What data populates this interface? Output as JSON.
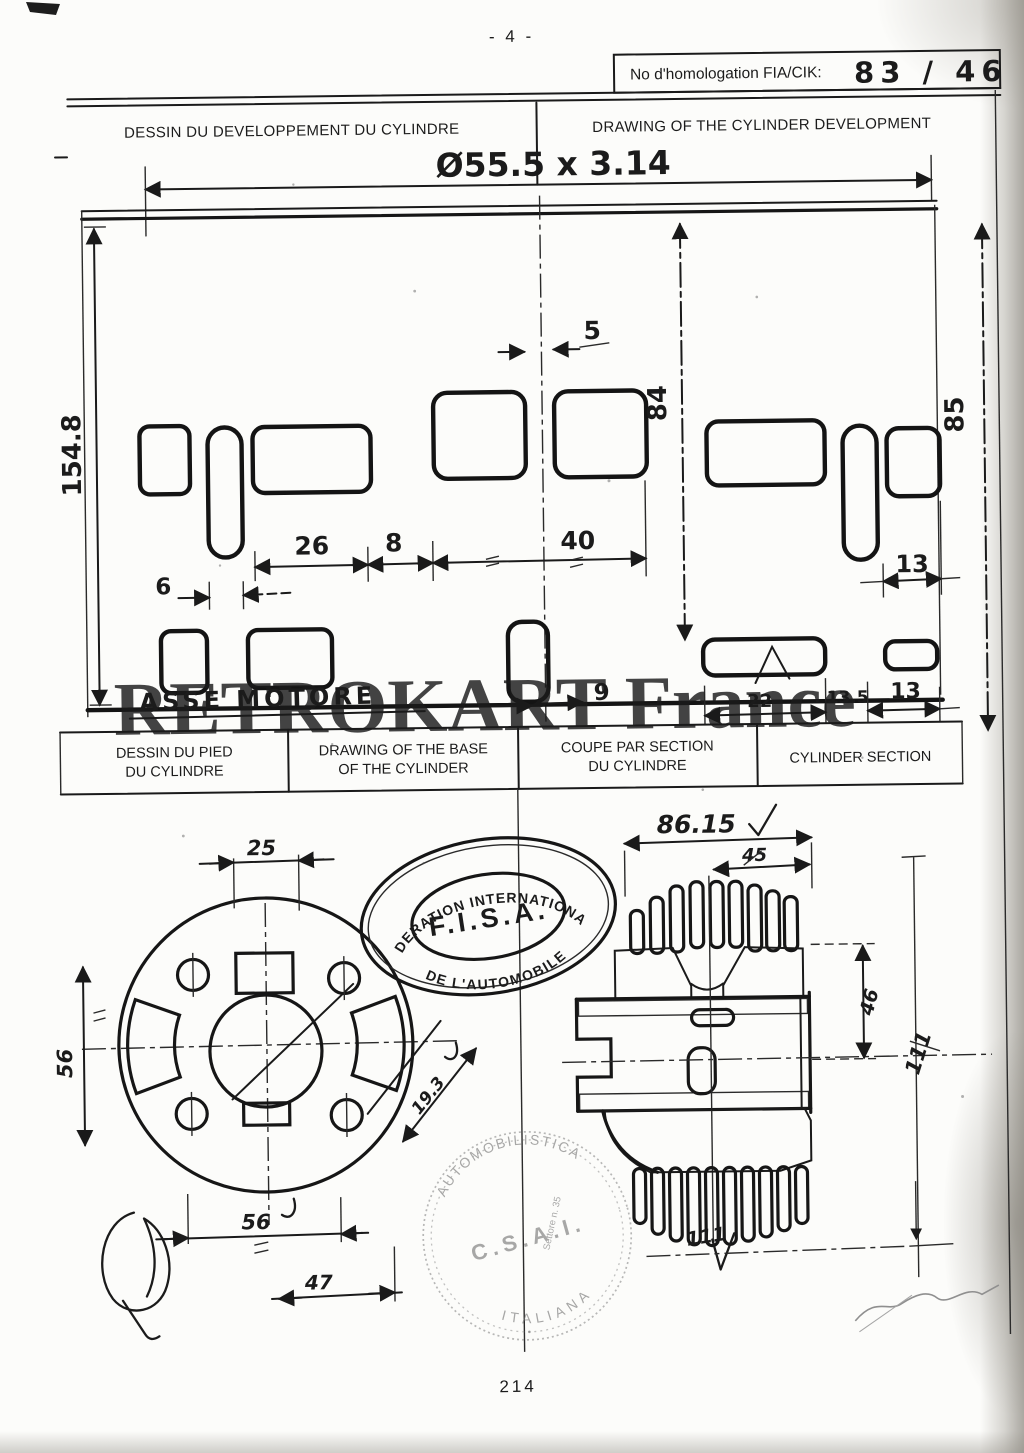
{
  "page": {
    "top_number": "- 4 -",
    "bottom_number": "214"
  },
  "homologation": {
    "label": "No d'homologation FIA/CIK:",
    "number": "83 / 46"
  },
  "titles": {
    "development_fr": "DESSIN DU DEVELOPPEMENT DU CYLINDRE",
    "development_en": "DRAWING OF THE CYLINDER DEVELOPMENT"
  },
  "table_headers": [
    [
      "DESSIN DU PIED",
      "DU CYLINDRE"
    ],
    [
      "DRAWING OF THE BASE",
      "OF THE CYLINDER"
    ],
    [
      "COUPE PAR SECTION",
      "DU CYLINDRE"
    ],
    [
      "CYLINDER SECTION",
      ""
    ]
  ],
  "development": {
    "top_dim": "Ø55.5 x 3.14",
    "height": "154.8",
    "port_height": "84",
    "outer_height": "85",
    "gap": "5",
    "w26": "26",
    "w8": "8",
    "w40": "40",
    "w6": "6",
    "w13_top": "13",
    "w9": "9",
    "w22": "22",
    "w13_5": "13.5",
    "w13_bottom": "13",
    "axis_note": "ASSE MOTORE"
  },
  "base": {
    "top": "25",
    "left": "56",
    "bottom_width": "56",
    "offset": "47",
    "diag": "19.3"
  },
  "section": {
    "overall_width": "86.15",
    "fin_width": "45",
    "inner_height": "46",
    "right_height": "111",
    "bottom_width": "111"
  },
  "stamps": {
    "fisa": {
      "top": "FEDERATION INTERNATIONALE",
      "center": "F.I.S.A.",
      "bottom": "DE L'AUTOMOBILE"
    },
    "csai": {
      "ring_top": "AUTOMOBILISTICA",
      "ring_bottom": "ITALIANA",
      "center": "C.S.A.I.",
      "small": "Settore n. 35"
    }
  },
  "watermark": {
    "text": "RETROKART France",
    "color": "#ee7d7d"
  }
}
